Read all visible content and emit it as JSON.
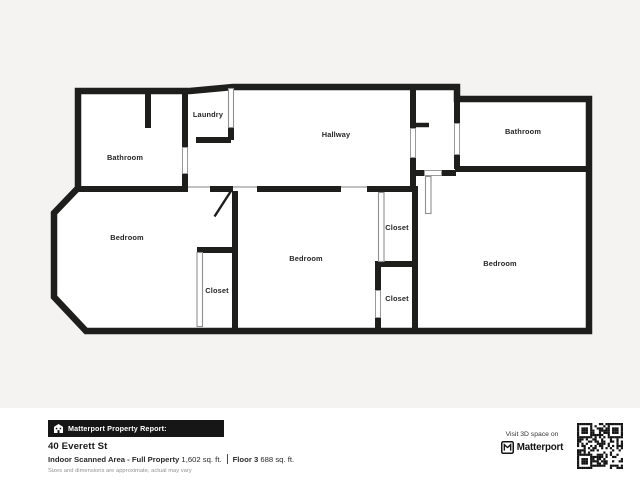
{
  "floorplan": {
    "labels": {
      "bathroom_left": "Bathroom",
      "laundry": "Laundry",
      "hallway": "Hallway",
      "bathroom_right": "Bathroom",
      "bedroom_left": "Bedroom",
      "bedroom_center": "Bedroom",
      "bedroom_right": "Bedroom",
      "closet_left": "Closet",
      "closet_upper": "Closet",
      "closet_lower": "Closet"
    }
  },
  "report": {
    "badge": "Matterport Property Report:",
    "address": "40 Everett St",
    "scanned_area_label": "Indoor Scanned Area - Full Property",
    "scanned_area_value": "1,602 sq. ft.",
    "floor_label": "Floor 3",
    "floor_value": "688 sq. ft.",
    "disclaimer": "Sizes and dimensions are approximate, actual may vary"
  },
  "promo": {
    "visit_label": "Visit 3D space on",
    "brand": "Matterport"
  },
  "colors": {
    "background": "#f4f3f1",
    "footer_background": "#ffffff",
    "wall": "#1e1e1c",
    "room_fill": "#ffffff",
    "label_text": "#262626",
    "door_line": "#8f8f8f",
    "badge_background": "#161616",
    "badge_text": "#ffffff",
    "disclaimer_text": "#969390"
  }
}
